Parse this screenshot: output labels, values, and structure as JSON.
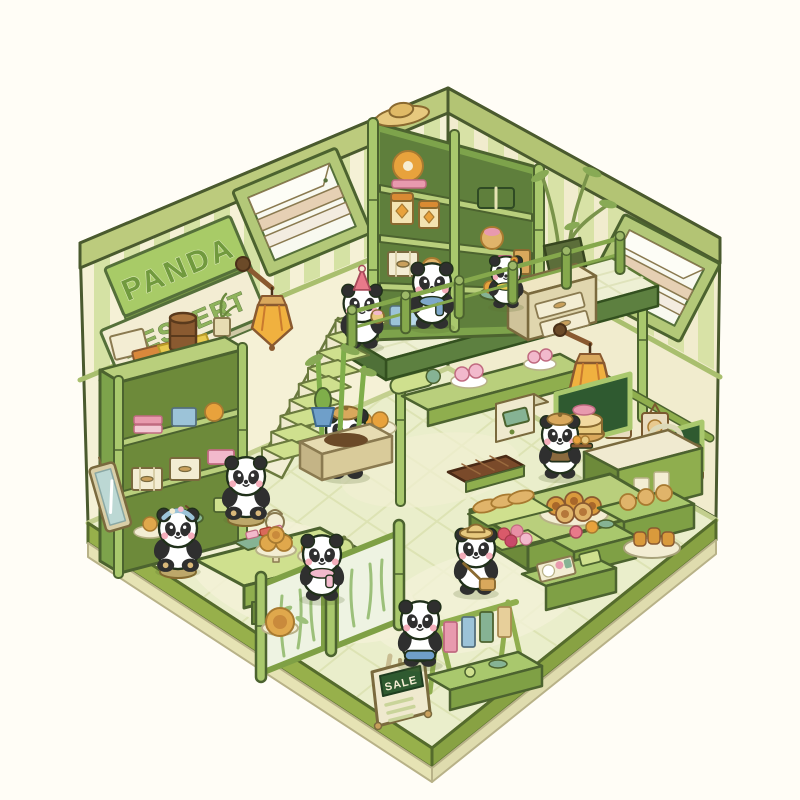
{
  "scene_title": "Panda Dessert Shop",
  "signs": {
    "line1": "PANDA",
    "line2": "DESSERT",
    "line3": "SHOP"
  },
  "sale_sign": {
    "title": "SALE"
  },
  "palette": {
    "background": "#fffdf6",
    "wall_cream": "#f5f1d6",
    "wall_stripe": "#d5e2a4",
    "beam": "#bccb7d",
    "outline": "#4a5a2e",
    "floor": "#eaeecb",
    "floor_path": "#f3f1d7",
    "platform": "#97b04b",
    "platform_base": "#e6e3b4",
    "shelf_green": "#8fae4e",
    "shelf_light": "#b9cf7c",
    "shelf_dark": "#6d8a3a",
    "bamboo": "#a9c86d",
    "lantern_orange": "#f0b13f",
    "wood_brown": "#8a5a30",
    "accent_orange": "#e8a23c",
    "pink": "#f2b9cc",
    "rose": "#e87a8a",
    "blue": "#9cc3d8",
    "panda_black": "#2f2f2f",
    "cheek_pink": "#f4aebb",
    "sign_board_green": "#a8cb67",
    "sign_board_cream": "#f3edd3",
    "sign_text_green": "#7fa653",
    "sale_plaque_green": "#2f5a30"
  },
  "scene": {
    "pandas": [
      {
        "name": "panda-party-hat",
        "layer": "deck",
        "x": 362,
        "y": 346,
        "s": 0.92,
        "hat": "party",
        "holding": "cake"
      },
      {
        "name": "panda-blue-scarf",
        "layer": "deck",
        "x": 432,
        "y": 326,
        "s": 0.95,
        "scarf": "#7ea8c9"
      },
      {
        "name": "panda-flower-collar",
        "layer": "deck",
        "x": 506,
        "y": 306,
        "s": 0.75,
        "flower": true,
        "scarf": "#e8c94e"
      },
      {
        "name": "panda-waiter-center",
        "layer": "backfloor",
        "x": 346,
        "y": 476,
        "s": 1.0,
        "hat": "beret",
        "apron": "#eef0d4",
        "holding": "cup"
      },
      {
        "name": "panda-waiter-right",
        "layer": "backfloor",
        "x": 560,
        "y": 476,
        "s": 0.9,
        "hat": "beret",
        "vest": "#8a6a3e",
        "holding": "tray"
      },
      {
        "name": "panda-seated-left",
        "layer": "floor",
        "x": 246,
        "y": 518,
        "s": 0.95,
        "seated": true
      },
      {
        "name": "panda-seated-headband",
        "layer": "floor",
        "x": 178,
        "y": 570,
        "s": 0.95,
        "seated": true,
        "band": true
      },
      {
        "name": "panda-straw-hat",
        "layer": "floor",
        "x": 476,
        "y": 592,
        "s": 0.95,
        "hat": "straw",
        "satchel": true
      },
      {
        "name": "panda-pink-scarf",
        "layer": "front",
        "x": 322,
        "y": 598,
        "s": 0.95,
        "scarf": "#f2b9cc"
      },
      {
        "name": "panda-blue-shorts",
        "layer": "front",
        "x": 420,
        "y": 664,
        "s": 0.95,
        "shorts": "#6f9fc9"
      }
    ],
    "stairs": {
      "steps": 9
    },
    "railing": {
      "posts": 6
    },
    "objects": [
      "striped-walls",
      "louvered-window-left",
      "louvered-window-right",
      "shop-sign-boards",
      "wall-lantern-left",
      "wall-lantern-right",
      "mezzanine-deck",
      "bamboo-railing",
      "staircase",
      "tall-bamboo-shelf",
      "drawer-cabinet",
      "bamboo-pot-plant",
      "hanging-menu-boards",
      "wall-niches",
      "sink-counter",
      "teapot",
      "produce-crates",
      "dessert-counters",
      "swirl-roll-plate",
      "bamboo-planter",
      "cash-register",
      "chocolate-tray",
      "left-storage-shelf",
      "wall-mirror",
      "tea-table",
      "cake-stand",
      "partition-screens",
      "towel-rack",
      "bento-crate",
      "sale-easel",
      "floor-tart",
      "cactus-pot"
    ]
  }
}
